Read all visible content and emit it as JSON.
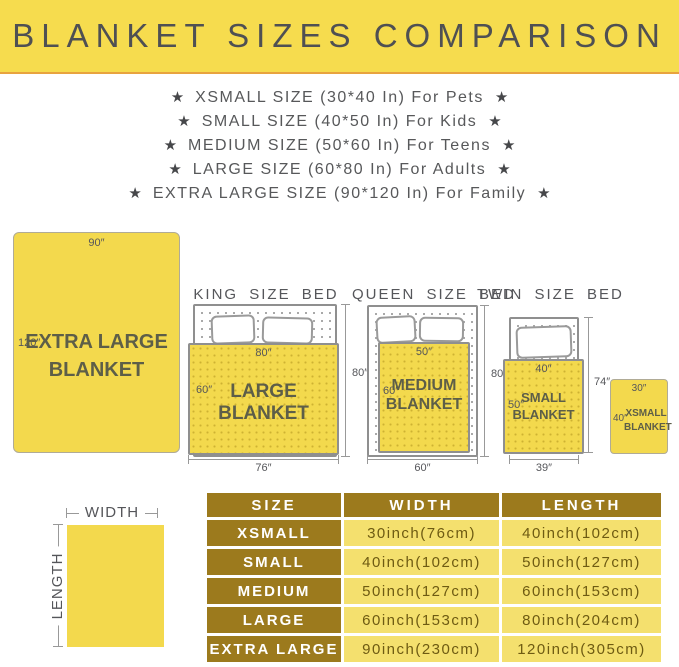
{
  "header": {
    "title": "BLANKET SIZES COMPARISON"
  },
  "icons": {
    "star": "★"
  },
  "size_list": [
    "XSMALL SIZE (30*40 In) For Pets",
    "SMALL SIZE (40*50 In) For Kids",
    "MEDIUM SIZE (50*60 In) For Teens",
    "LARGE SIZE (60*80 In) For Adults",
    "EXTRA LARGE SIZE (90*120 In) For Family"
  ],
  "diagram": {
    "xl": {
      "width_dim": "90″",
      "length_dim": "120″",
      "label1": "EXTRA LARGE",
      "label2": "BLANKET"
    },
    "king": {
      "title": "KING SIZE BED",
      "blanket_width": "80″",
      "blanket_length": "60″",
      "label": "LARGE BLANKET",
      "bed_length": "80″",
      "bed_width": "76″"
    },
    "queen": {
      "title": "QUEEN SIZE BED",
      "blanket_width": "50″",
      "blanket_length": "60″",
      "label1": "MEDIUM",
      "label2": "BLANKET",
      "bed_length": "80″",
      "bed_width": "60″"
    },
    "twin": {
      "title": "TWIN SIZE BED",
      "blanket_width": "40″",
      "blanket_length": "50″",
      "label1": "SMALL",
      "label2": "BLANKET",
      "bed_length": "74″",
      "bed_width": "39″"
    },
    "xsmall": {
      "width_dim": "30″",
      "length_dim": "40″",
      "label1": "XSMALL",
      "label2": "BLANKET"
    }
  },
  "legend": {
    "width": "WIDTH",
    "length": "LENGTH"
  },
  "table": {
    "headers": [
      "SIZE",
      "WIDTH",
      "LENGTH"
    ],
    "rows": [
      {
        "size": "XSMALL",
        "width": "30inch(76cm)",
        "length": "40inch(102cm)"
      },
      {
        "size": "SMALL",
        "width": "40inch(102cm)",
        "length": "50inch(127cm)"
      },
      {
        "size": "MEDIUM",
        "width": "50inch(127cm)",
        "length": "60inch(153cm)"
      },
      {
        "size": "LARGE",
        "width": "60inch(153cm)",
        "length": "80inch(204cm)"
      },
      {
        "size": "EXTRA LARGE",
        "width": "90inch(230cm)",
        "length": "120inch(305cm)"
      }
    ]
  },
  "colors": {
    "banner_yellow": "#f6dc4e",
    "accent_orange": "#e8a33f",
    "blanket_yellow": "#f3d94d",
    "table_gold": "#9c7a1d",
    "table_yellow": "#f4e06e",
    "text_gray": "#55565a"
  }
}
